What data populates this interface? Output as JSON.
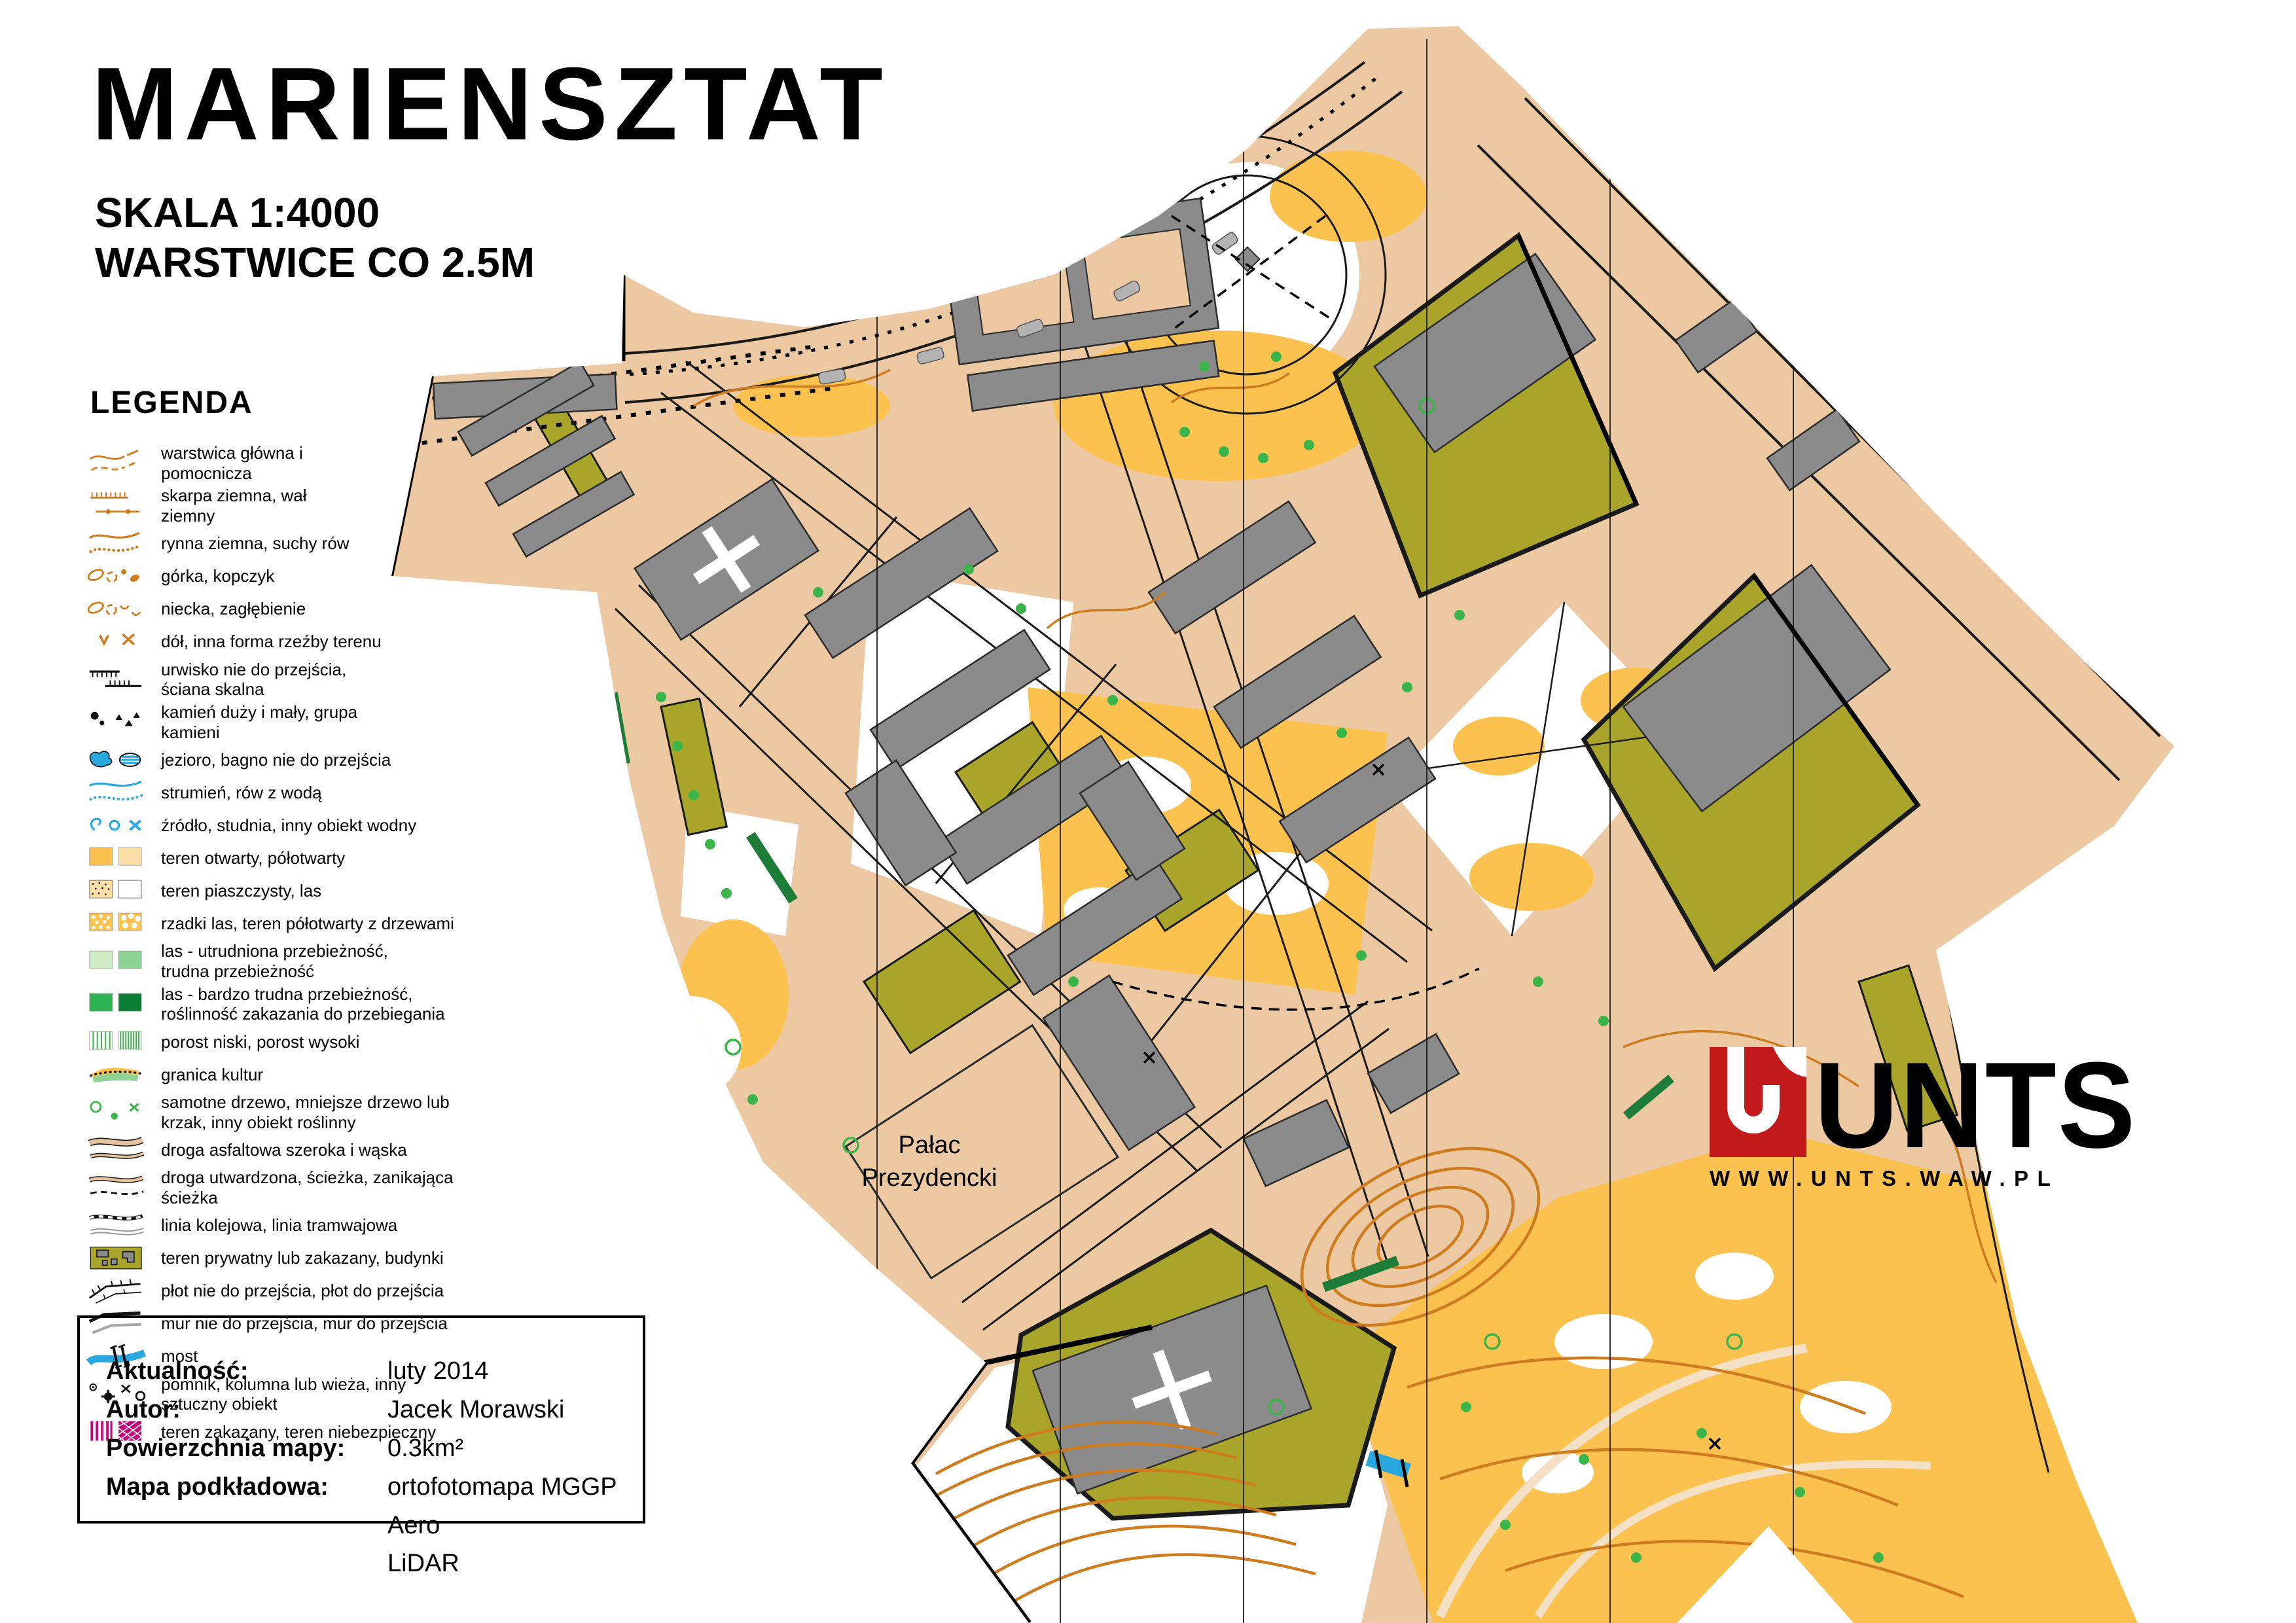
{
  "header": {
    "title": "MARIENSZTAT",
    "scale": "SKALA 1:4000",
    "contour_interval": "WARSTWICE CO 2.5M"
  },
  "legend": {
    "heading": "LEGENDA",
    "items": [
      {
        "icon": "contour-lines-icon",
        "label": "warstwica główna i\npomocnicza"
      },
      {
        "icon": "earth-bank-icon",
        "label": "skarpa ziemna, wał\nziemny"
      },
      {
        "icon": "erosion-gully-icon",
        "label": "rynna ziemna, suchy rów"
      },
      {
        "icon": "knoll-icon",
        "label": "górka, kopczyk"
      },
      {
        "icon": "depression-icon",
        "label": "niecka, zagłębienie"
      },
      {
        "icon": "pit-icon",
        "label": "dół, inna forma rzeźby terenu"
      },
      {
        "icon": "cliff-icon",
        "label": "urwisko nie do przejścia,\nściana skalna"
      },
      {
        "icon": "boulder-icon",
        "label": "kamień duży i mały, grupa\nkamieni"
      },
      {
        "icon": "lake-marsh-icon",
        "label": "jezioro, bagno nie do przejścia"
      },
      {
        "icon": "stream-icon",
        "label": "strumień, rów z wodą"
      },
      {
        "icon": "water-feature-icon",
        "label": "źródło, studnia, inny obiekt wodny"
      },
      {
        "icon": "open-land-icon",
        "label": "teren otwarty, półotwarty"
      },
      {
        "icon": "sandy-forest-icon",
        "label": "teren piaszczysty, las"
      },
      {
        "icon": "sparse-forest-icon",
        "label": "rzadki las, teren półotwarty z drzewami"
      },
      {
        "icon": "forest-slow-icon",
        "label": "las - utrudniona przebieżność,\ntrudna przebieżność"
      },
      {
        "icon": "forest-difficult-icon",
        "label": "las - bardzo trudna przebieżność,\nroślinność zakazania do przebiegania"
      },
      {
        "icon": "undergrowth-icon",
        "label": "porost niski, porost wysoki"
      },
      {
        "icon": "cultivation-boundary-icon",
        "label": "granica kultur"
      },
      {
        "icon": "tree-icon",
        "label": "samotne drzewo, mniejsze drzewo lub\nkrzak, inny obiekt roślinny"
      },
      {
        "icon": "paved-road-icon",
        "label": "droga asfaltowa szeroka i wąska"
      },
      {
        "icon": "path-icon",
        "label": "droga utwardzona, ścieżka, zanikająca\nścieżka"
      },
      {
        "icon": "railway-icon",
        "label": "linia kolejowa, linia tramwajowa"
      },
      {
        "icon": "private-area-icon",
        "label": "teren prywatny lub zakazany, budynki"
      },
      {
        "icon": "fence-icon",
        "label": "płot nie do przejścia, płot do przejścia"
      },
      {
        "icon": "wall-icon",
        "label": "mur nie do przejścia, mur do przejścia"
      },
      {
        "icon": "bridge-icon",
        "label": "most"
      },
      {
        "icon": "monument-icon",
        "label": "pomnik, kolumna lub wieża, inny\nsztuczny obiekt"
      },
      {
        "icon": "forbidden-area-icon",
        "label": "teren zakazany, teren niebezpieczny"
      }
    ]
  },
  "info_box": {
    "rows": [
      {
        "label": "Aktualność:",
        "value": "luty 2014"
      },
      {
        "label": "Autor:",
        "value": "Jacek Morawski"
      },
      {
        "label": "Powierzchnia mapy:",
        "value": "0.3km²"
      },
      {
        "label": "Mapa podkładowa:",
        "value": "ortofotomapa MGGP Aero\nLiDAR"
      }
    ]
  },
  "logo": {
    "word": "UNTS",
    "url": "WWW.UNTS.WAW.PL",
    "accent": "#c21a1a"
  },
  "map": {
    "palac_line1": "Pałac",
    "palac_line2": "Prezydencki",
    "colors": {
      "paved": "#ecc9a2",
      "road_light": "#f4e0c4",
      "open_yellow": "#fcc24f",
      "open_pale": "#fbdfa6",
      "olive_forbidden": "#a9a52b",
      "building_gray": "#8b8b8b",
      "contour_orange": "#cf7c1e",
      "water_blue": "#29a8e0",
      "tree_green": "#3bb54a",
      "dark_green": "#1d7c38",
      "forbidden_magenta": "#c4087c"
    }
  }
}
